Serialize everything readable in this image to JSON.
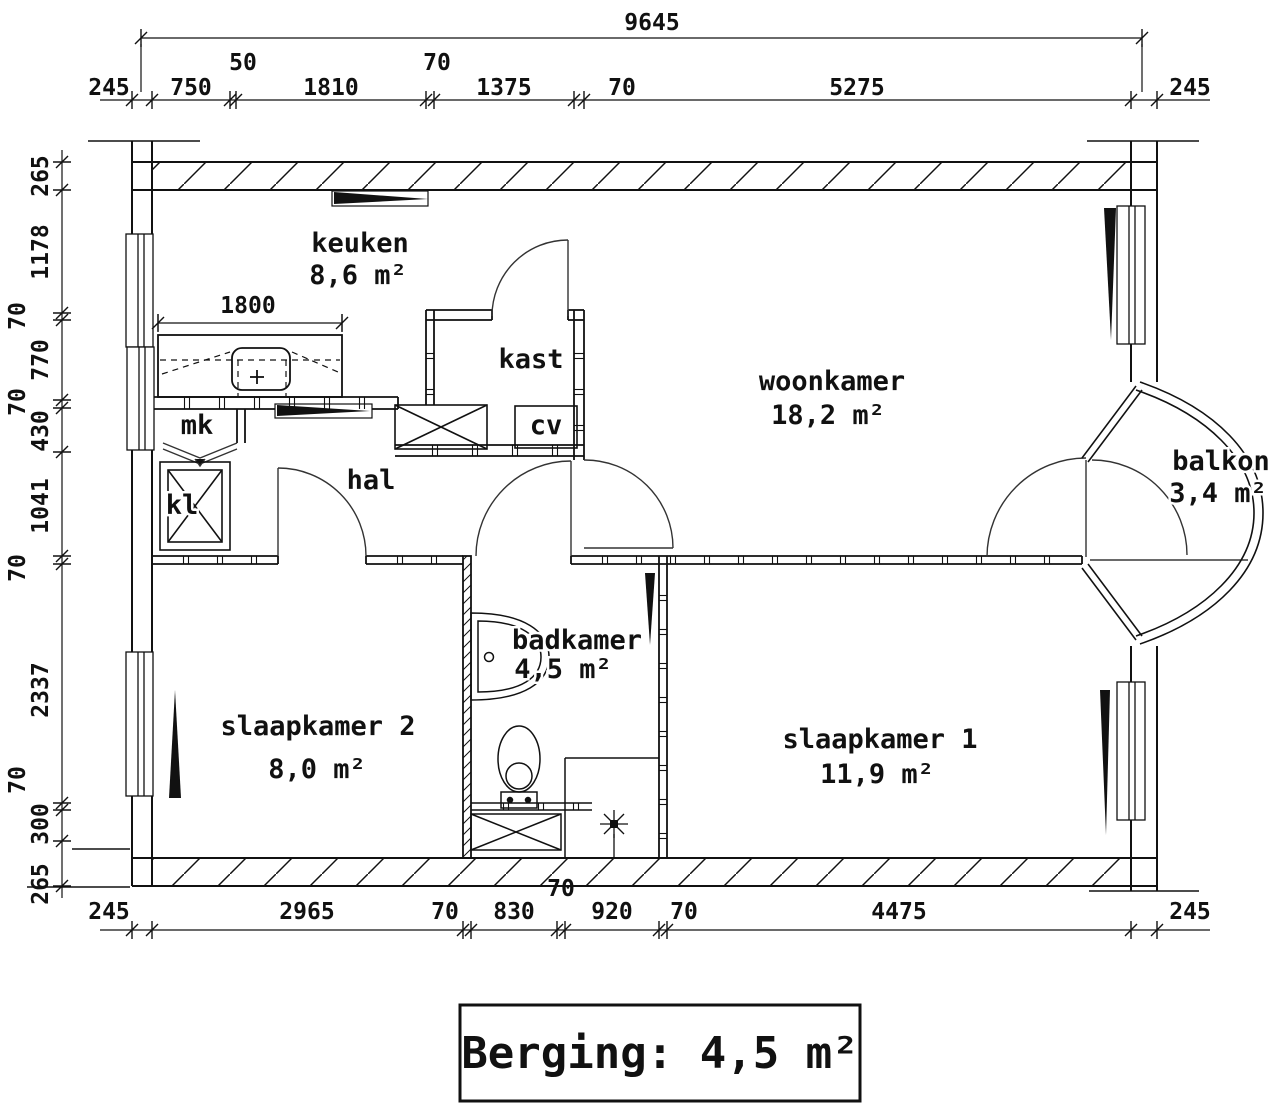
{
  "rooms": [
    {
      "label": "keuken",
      "area": "8,6 m²"
    },
    {
      "label": "kast"
    },
    {
      "label": "cv"
    },
    {
      "label": "mk"
    },
    {
      "label": "kl"
    },
    {
      "label": "hal"
    },
    {
      "label": "woonkamer",
      "area": "18,2 m²"
    },
    {
      "label": "balkon",
      "area": "3,4 m²"
    },
    {
      "label": "badkamer",
      "area": "4,5 m²"
    },
    {
      "label": "slaapkamer 2",
      "area": "8,0 m²"
    },
    {
      "label": "slaapkamer 1",
      "area": "11,9 m²"
    }
  ],
  "dims": {
    "overall_width": "9645",
    "kitchen_counter": "1800",
    "top": [
      "245",
      "750",
      "50",
      "1810",
      "70",
      "1375",
      "70",
      "5275",
      "245"
    ],
    "bottom": [
      "245",
      "2965",
      "70",
      "830",
      "70",
      "920",
      "70",
      "4475",
      "245"
    ],
    "left": [
      "265",
      "1178",
      "70",
      "770",
      "70",
      "430",
      "1041",
      "70",
      "2337",
      "70",
      "300",
      "265"
    ]
  },
  "storage_note": "Berging: 4,5 m²"
}
